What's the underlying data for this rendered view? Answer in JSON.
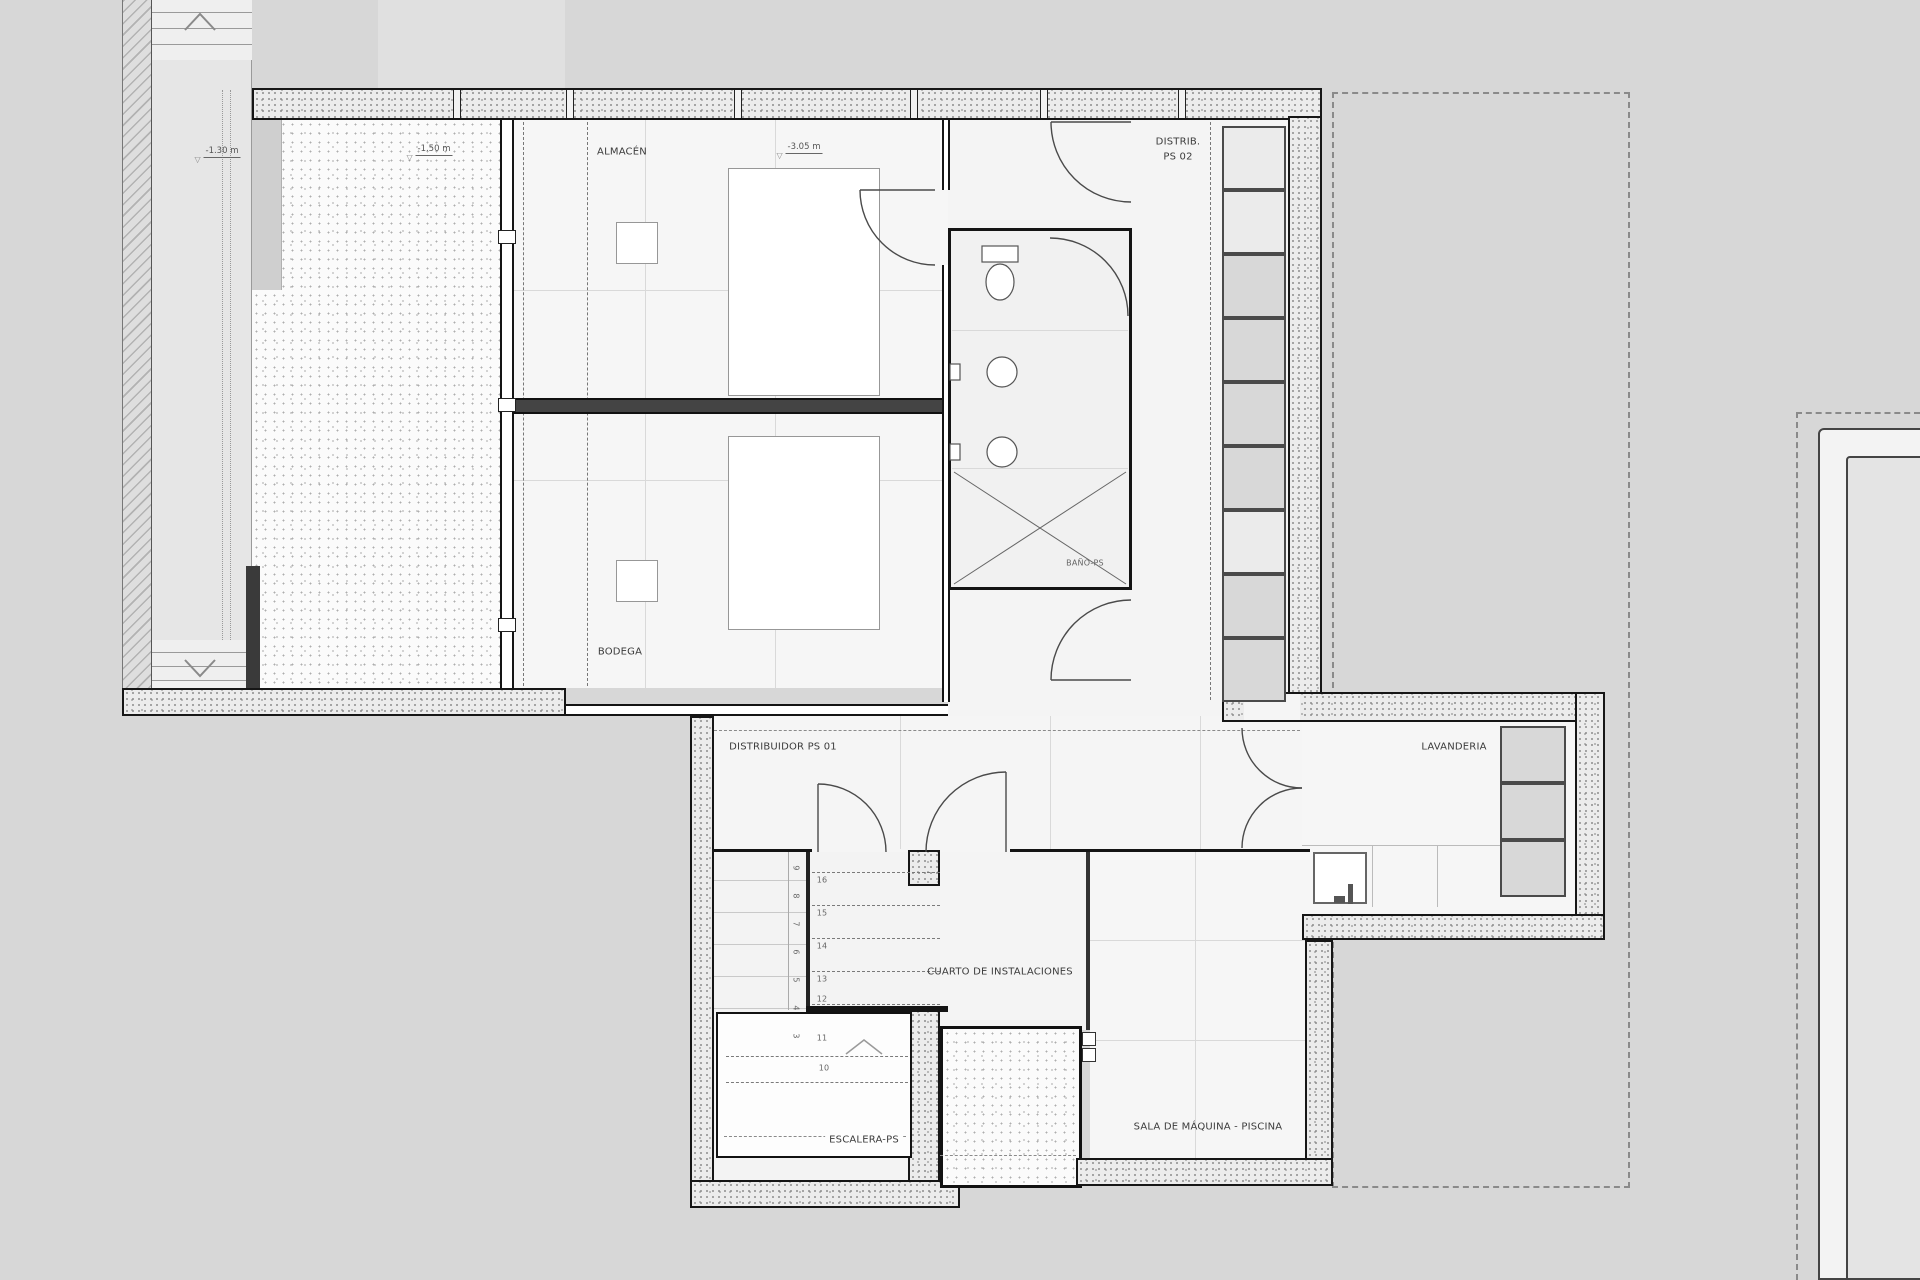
{
  "labels": {
    "almacen": "ALMACÉN",
    "bodega": "BODEGA",
    "bano_ps": "BAÑO-PS",
    "distrib_ps02_l1": "DISTRIB.",
    "distrib_ps02_l2": "PS 02",
    "distribuidor_ps01": "DISTRIBUIDOR PS 01",
    "lavanderia": "LAVANDERIA",
    "cuarto_instalaciones": "CUARTO DE INSTALACIONES",
    "escalera_ps": "ESCALERA-PS",
    "sala_maquina_piscina": "SALA DE MÁQUINA - PISCINA"
  },
  "levels": {
    "exterior_stair": "-1.30 m",
    "courtyard": "-1.50 m",
    "interior": "-3.05 m"
  },
  "stair_numbers": {
    "upper_flight": [
      "16",
      "15",
      "14",
      "13",
      "12"
    ],
    "lower_flight": [
      "11",
      "10"
    ],
    "side_flight": [
      "9",
      "8",
      "7",
      "6",
      "5",
      "4",
      "3"
    ]
  },
  "colors": {
    "background": "#d7d7d7",
    "wall_line": "#161616",
    "floor": "#f5f5f5",
    "label_text": "#3b3b3b"
  }
}
